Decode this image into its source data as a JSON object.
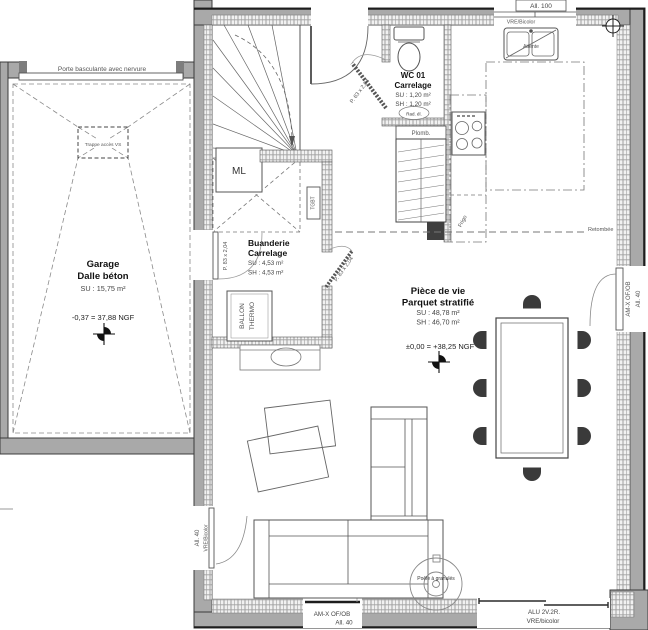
{
  "garage": {
    "name": "Garage",
    "floor": "Dalle béton",
    "area_su": "SU : 15,75 m²",
    "level": "-0,37 = 37,88 NGF",
    "door": "Porte basculante avec nervure",
    "trap": "Trappe accès VS"
  },
  "wc": {
    "name": "WC 01",
    "floor": "Carrelage",
    "area_su": "SU : 1,20 m²",
    "area_sh": "SH : 1,20 m²",
    "door": "P. 63 x 2,04",
    "plumbing": "Plomb.",
    "radiator": "Rad. él."
  },
  "laundry": {
    "name": "Buanderie",
    "floor": "Carrelage",
    "area_su": "SU : 4,53 m²",
    "area_sh": "SH : 4,53 m²",
    "door": "P. 83 x 2,04",
    "garage_door": "P. 83 x 2,04",
    "electrical_panel": "TGBT",
    "washing_machine": "ML",
    "water_heater_line1": "BALLON",
    "water_heater_line2": "THERMO"
  },
  "living": {
    "name": "Pièce de vie",
    "floor": "Parquet stratifié",
    "area_su": "SU : 48,78 m²",
    "area_sh": "SH : 46,70 m²",
    "level": "±0,00 = +38,25 NGF",
    "stove": "Poêle à granulés",
    "beam": "Retombée"
  },
  "kitchen": {
    "sink_note": "Attente",
    "fridge": "Frigo"
  },
  "windows": {
    "top_type": "VRE/Bicolor",
    "top_sill": "All. 100",
    "right_type": "AM-X OF/OB",
    "right_sill": "All. 40",
    "left_type": "VRE/Bicolor",
    "left_sill": "All. 40",
    "bottom_type": "AM-X OF/OB",
    "bottom_sill": "All. 40",
    "bay_type": "ALU 2V.2R.",
    "bay_finish": "VRE/bicolor"
  },
  "colors": {
    "wall_fill": "#a9a9a9",
    "hatch_line": "#a0a0a0",
    "line": "#3c3c3c",
    "text_dark": "#111111",
    "text_grey": "#555555"
  }
}
